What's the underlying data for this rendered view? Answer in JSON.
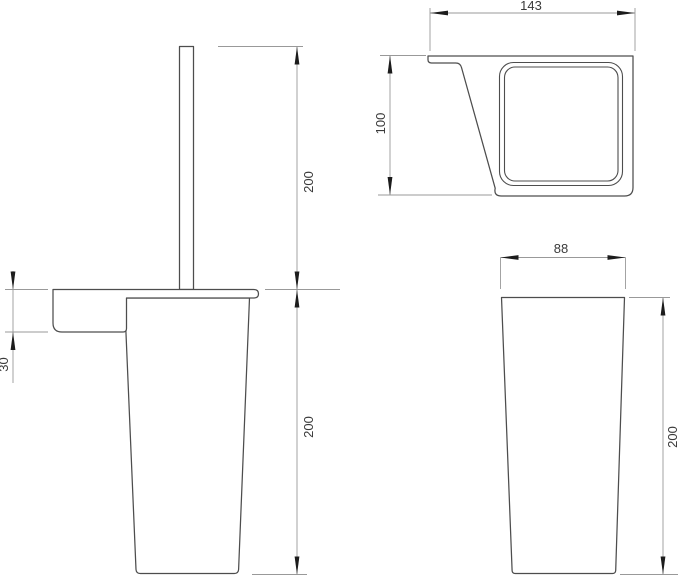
{
  "colors": {
    "background": "#ffffff",
    "outline": "#4d4d4d",
    "dimension_lines": "#999999",
    "arrows": "#1c1c1c",
    "text": "#3a3a3a"
  },
  "views": {
    "front": {
      "dimensions": {
        "handle_height": "200",
        "bracket_depth": "30",
        "cup_height": "200"
      }
    },
    "top": {
      "dimensions": {
        "overall_width": "143",
        "overall_depth": "100"
      }
    },
    "side": {
      "dimensions": {
        "cup_width": "88",
        "cup_height": "200"
      }
    }
  }
}
